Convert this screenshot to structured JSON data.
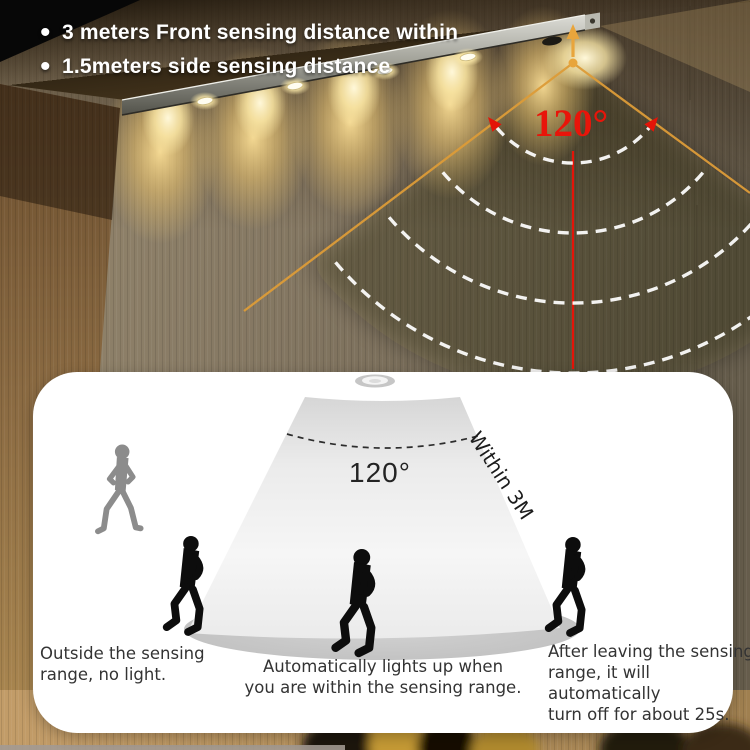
{
  "banner": {
    "bullet_char": "•",
    "bullets": [
      "3 meters Front sensing distance within",
      "1.5meters side sensing distance"
    ],
    "angle_label": "120°"
  },
  "diagram": {
    "angle_label": "120°",
    "range_label": "Within 3M",
    "captions": {
      "outside": [
        "Outside the sensing",
        "range, no light."
      ],
      "inside": [
        "Automatically lights up when",
        "you are within the sensing range."
      ],
      "leaving": [
        "After leaving the sensing",
        "range, it will automatically",
        "turn off for about 25s."
      ]
    }
  },
  "colors": {
    "angle_red": "#e8150a",
    "cone_line_orange": "#dd9c38",
    "warm_light": "#f3cf85",
    "arc_white": "#ffffff",
    "panel_bg": "#ffffff",
    "figure_black": "#0d0d0d",
    "figure_gray": "#8c8c8c"
  }
}
